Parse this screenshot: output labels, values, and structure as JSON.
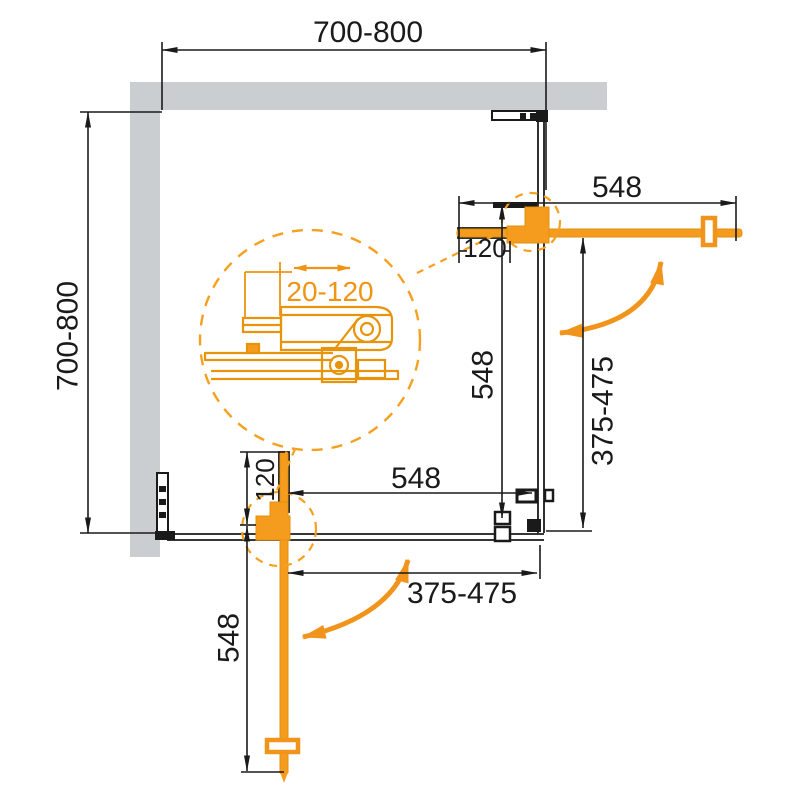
{
  "drawing_type": "shower-enclosure-corner-technical-drawing",
  "colors": {
    "accent_orange": "#F59C1E",
    "accent_orange_dark": "#EF9413",
    "line_black": "#1A1A1A",
    "wall_gray": "#CBCED1"
  },
  "dimensions": {
    "overall_width": "700-800",
    "overall_depth": "700-800",
    "door_top": "548",
    "door_span_right": "548",
    "door_span_bottom": "548",
    "door_bottom": "548",
    "profile_adjust_top": "120",
    "profile_adjust_bottom": "120",
    "fixed_panel_right": "375-475",
    "fixed_panel_bottom": "375-475",
    "detail_adjust_range": "20-120"
  }
}
